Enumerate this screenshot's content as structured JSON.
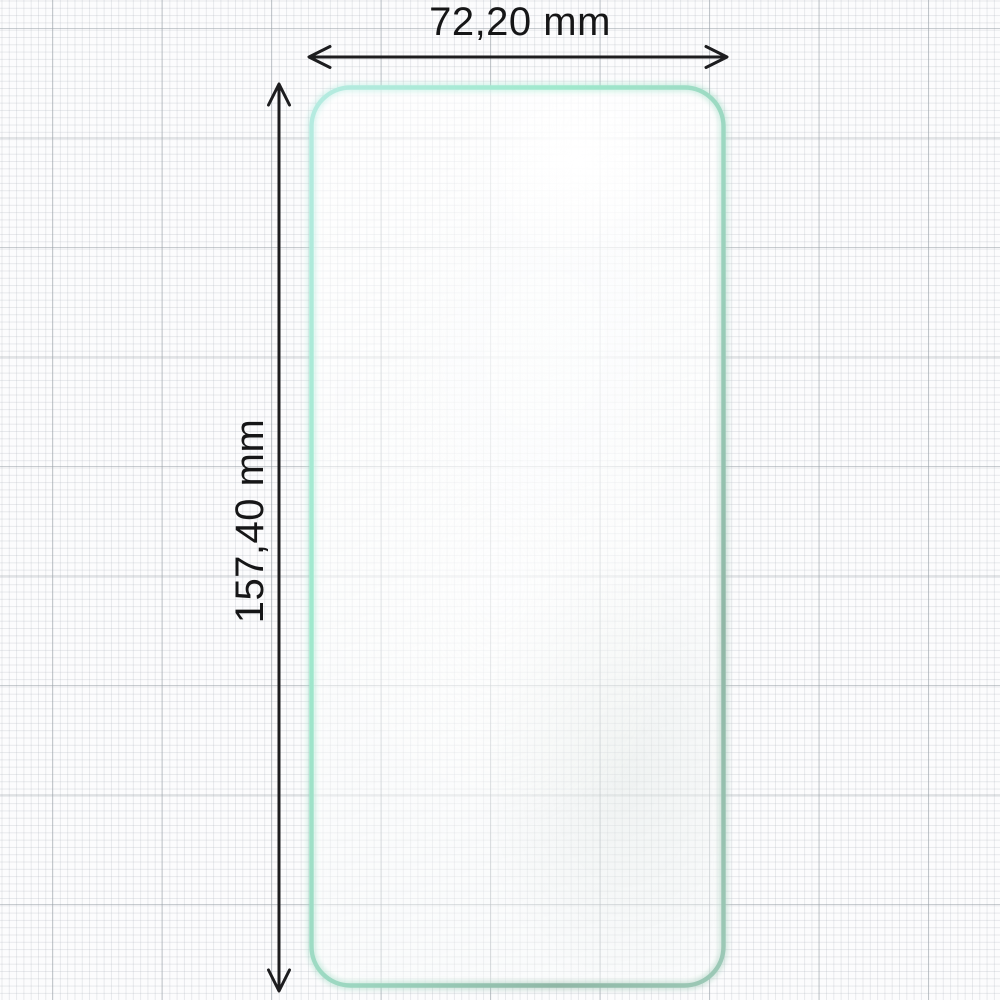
{
  "diagram": {
    "type": "product-dimension-diagram",
    "subject": "hydrogel screen protector film",
    "width_label": "72,20 mm",
    "height_label": "157,40 mm",
    "width_value": "72,20",
    "height_value": "157,40",
    "unit": "mm"
  },
  "film": {
    "border_gradient": [
      "#b6ebe1",
      "#9fe9cd",
      "#9cd6c0",
      "#90b7a6",
      "#9ccab7"
    ]
  },
  "style": {
    "paper_background": "#fcfcfd",
    "grid_minor_color": "#ebedef",
    "grid_major_color": "#d5d9dc",
    "dimension_ink": "#1d1d1f",
    "label_color": "#161617"
  }
}
